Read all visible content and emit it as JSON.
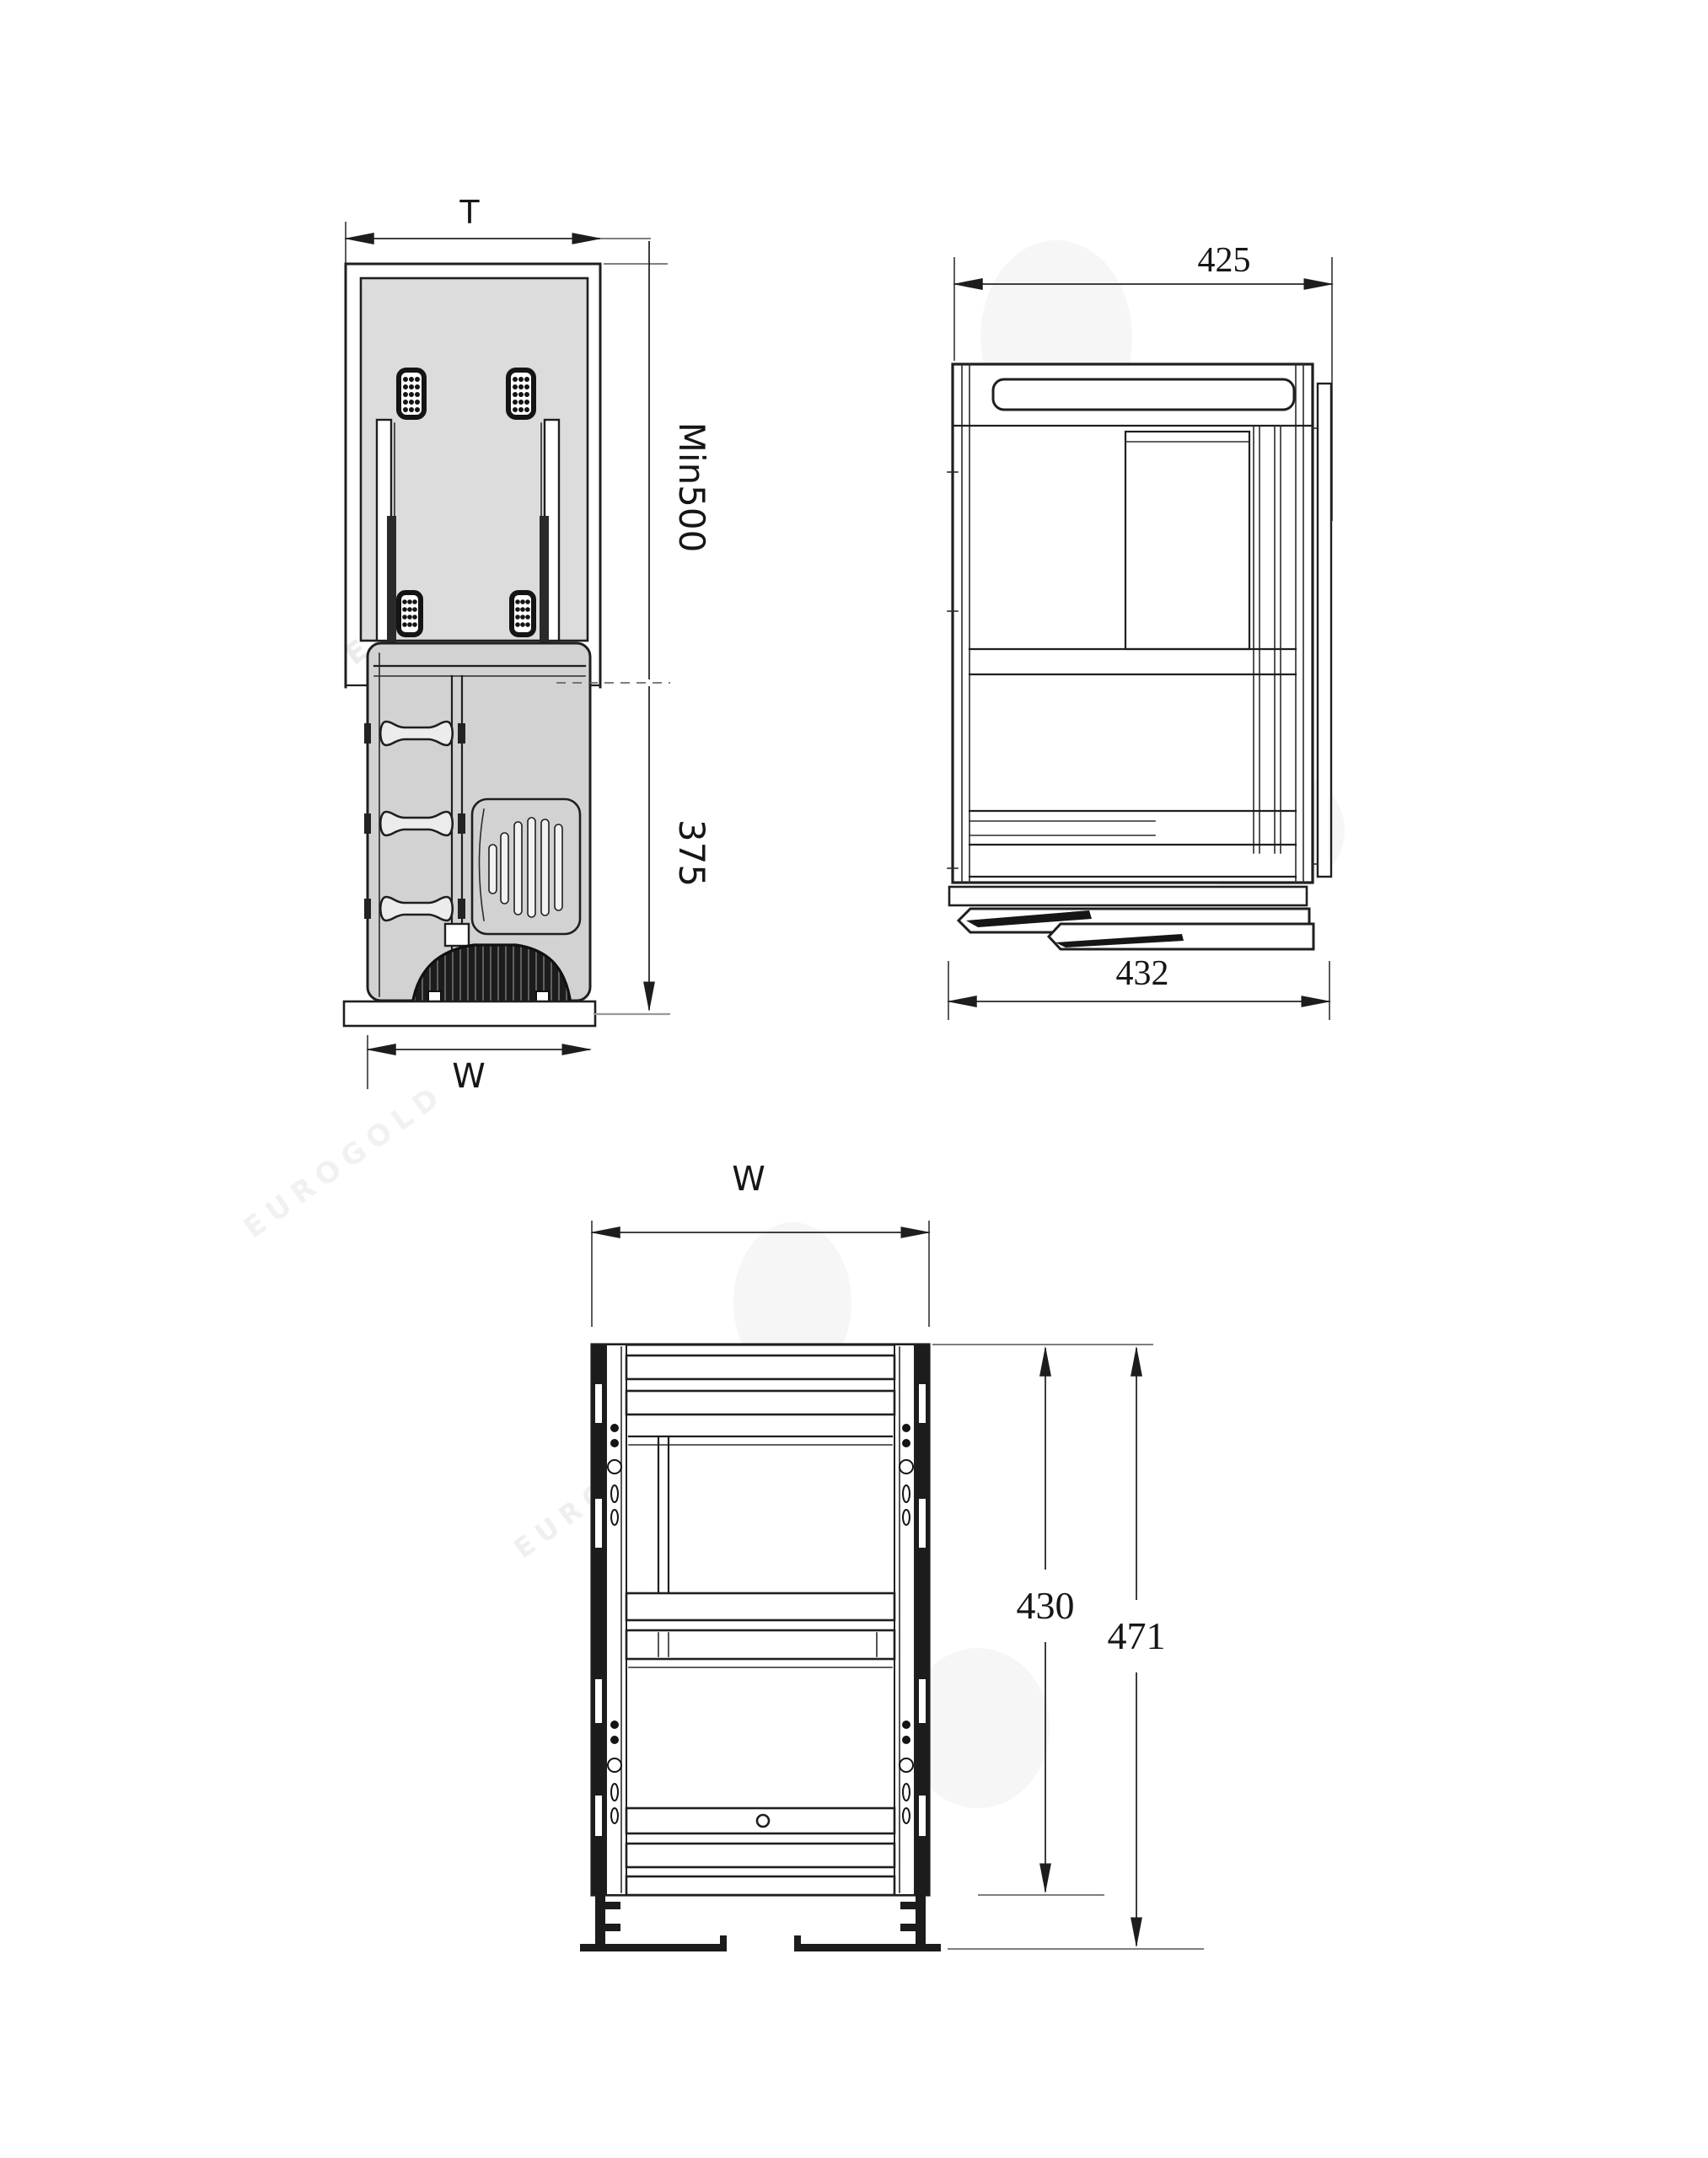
{
  "diagram": {
    "watermark": "EUROGOLD",
    "views": {
      "top": {
        "width_label": "T",
        "depth_label": "Min500",
        "extension_label": "375",
        "front_width_label": "W"
      },
      "side": {
        "top_width_label": "425",
        "bottom_width_label": "432"
      },
      "front": {
        "width_label": "W",
        "inner_height_label": "430",
        "total_height_label": "471"
      }
    },
    "colors": {
      "line": "#1f1f1f",
      "interior_gray": "#dcdcdc",
      "basket_gray": "#d2d2d2",
      "handle_gray": "#ececec",
      "dark_part": "#1c1c1c",
      "watermark_gray": "#b3b3b3"
    }
  }
}
